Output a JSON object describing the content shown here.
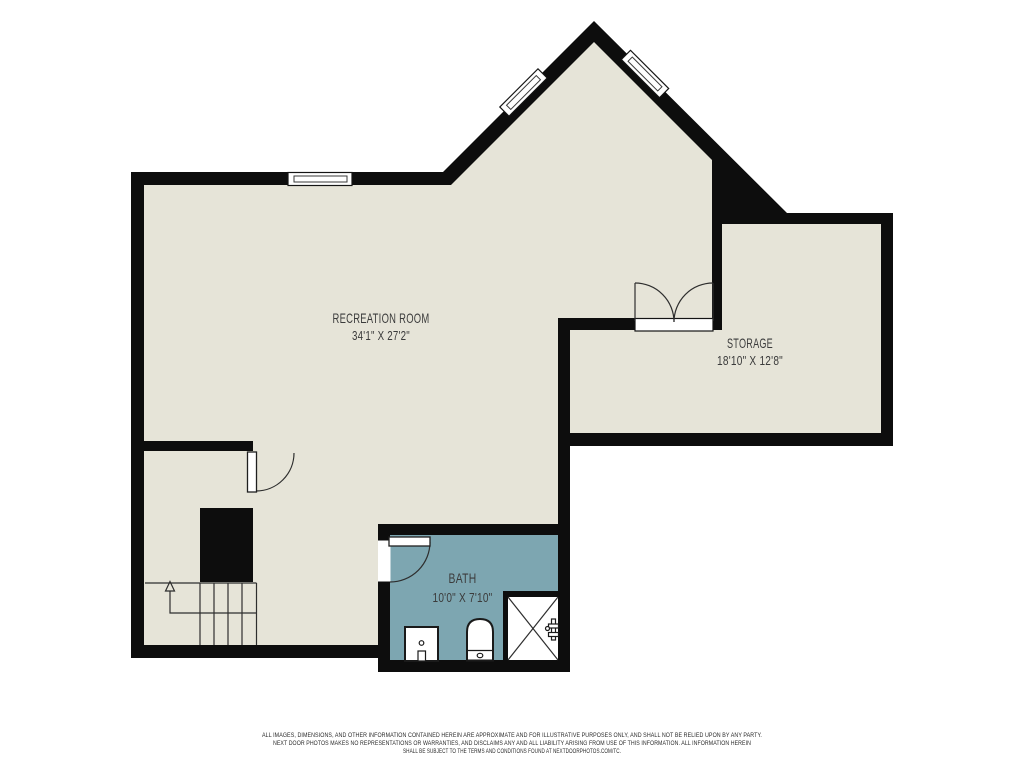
{
  "colors": {
    "background": "#ffffff",
    "walls": "#0d0d0d",
    "floor": "#e6e4d8",
    "bath_floor": "#7da6b1",
    "label_text": "#3b3b3b"
  },
  "rooms": {
    "recreation": {
      "name": "RECREATION ROOM",
      "dimensions": "34'1\" X 27'2\""
    },
    "storage": {
      "name": "STORAGE",
      "dimensions": "18'10\" X 12'8\""
    },
    "bath": {
      "name": "BATH",
      "dimensions": "10'0\" X 7'10\""
    }
  },
  "disclaimer": {
    "line1": "ALL IMAGES, DIMENSIONS, AND OTHER INFORMATION CONTAINED HEREIN ARE APPROXIMATE AND FOR ILLUSTRATIVE PURPOSES ONLY, AND SHALL NOT BE RELIED UPON BY ANY PARTY.",
    "line2": "NEXT DOOR PHOTOS MAKES NO REPRESENTATIONS OR WARRANTIES, AND DISCLAIMS ANY AND ALL LIABILITY ARISING FROM USE OF THIS INFORMATION. ALL INFORMATION HEREIN",
    "line3": "SHALL BE SUBJECT TO THE TERMS AND CONDITIONS FOUND AT NEXTDOORPHOTOS.COM/TC."
  }
}
